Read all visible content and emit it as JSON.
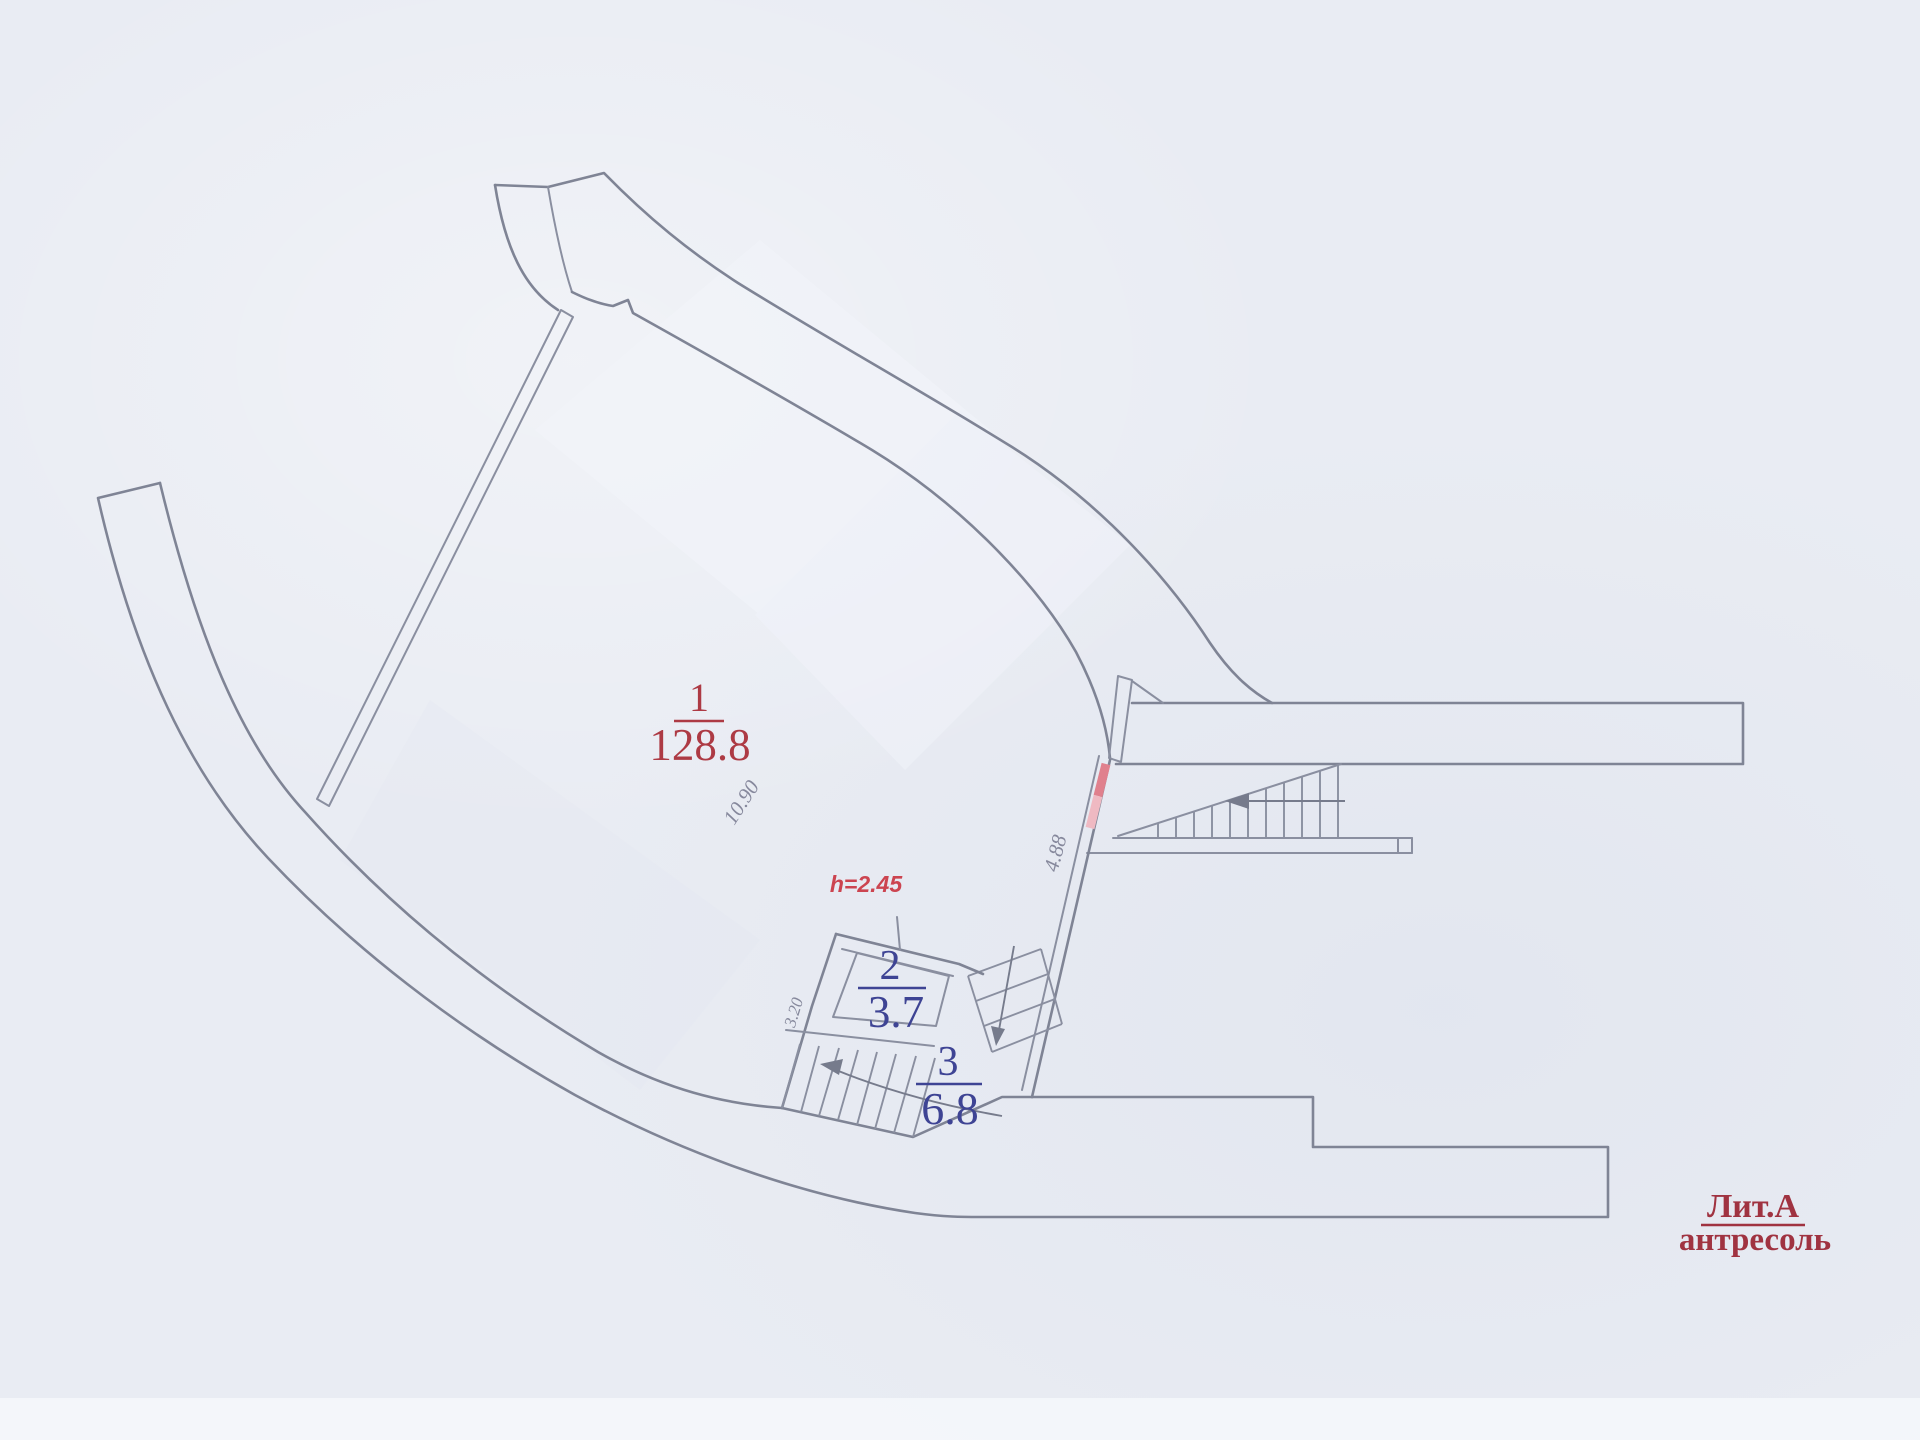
{
  "plan": {
    "rooms": [
      {
        "number": "1",
        "area": "128.8"
      },
      {
        "number": "2",
        "area": "3.7"
      },
      {
        "number": "3",
        "area": "6.8"
      }
    ],
    "height_note": "h=2.45",
    "dimensions": {
      "hall_width": "10.90",
      "diagonal_wall": "4.88",
      "stair_flight": "3.20"
    },
    "legend": {
      "litera": "Лит.А",
      "level": "антресоль"
    }
  },
  "colors": {
    "room1_label": "#ad3a44",
    "room_blue_label": "#3e4494",
    "height_note": "#cc4450",
    "legend_red": "#a03341",
    "dimension_gray": "#86889c",
    "wall": "#7f8495",
    "door_pink_strong": "#e0808d",
    "door_pink_light": "#efb9c2"
  }
}
